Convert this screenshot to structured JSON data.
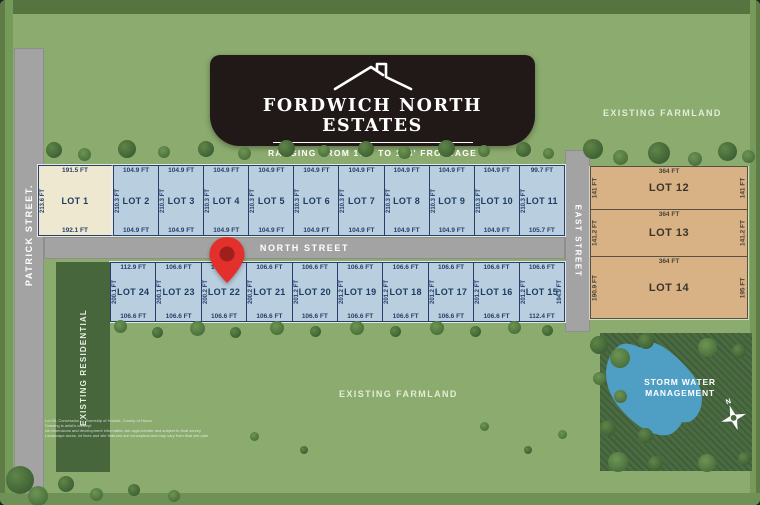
{
  "banner": {
    "title": "FORDWICH NORTH ESTATES",
    "subtitle": "RANGING FROM 104' TO 194' FRONTAGE"
  },
  "streets": {
    "patrick": "PATRICK STREET.",
    "north": "NORTH STREET",
    "east": "EAST STREET"
  },
  "labels": {
    "farmland_top": "EXISTING FARMLAND",
    "farmland_bottom": "EXISTING FARMLAND",
    "residential": "EXISTING RESIDENTIAL",
    "storm_water": "STORM WATER MANAGEMENT",
    "compass_n": "N"
  },
  "colors": {
    "lot_blue": "#b9cedf",
    "lot_cream": "#efe8d0",
    "lot_tan": "#d8b184",
    "road_gray": "#a3a3a3",
    "pin_red": "#e3302c",
    "map_green": "#8cab6e",
    "zone_dark_green": "#47663c",
    "dimension_text": "#27406b"
  },
  "lots": {
    "top_row": [
      {
        "name": "LOT 1",
        "top": "191.5 FT",
        "bottom": "192.1 FT",
        "side": "213.6 FT"
      },
      {
        "name": "LOT 2",
        "top": "104.9 FT",
        "bottom": "104.9 FT",
        "side": "210.3 FT"
      },
      {
        "name": "LOT 3",
        "top": "104.9 FT",
        "bottom": "104.9 FT",
        "side": "210.3 FT"
      },
      {
        "name": "LOT 4",
        "top": "104.9 FT",
        "bottom": "104.9 FT",
        "side": "210.3 FT"
      },
      {
        "name": "LOT 5",
        "top": "104.9 FT",
        "bottom": "104.9 FT",
        "side": "210.3 FT"
      },
      {
        "name": "LOT 6",
        "top": "104.9 FT",
        "bottom": "104.9 FT",
        "side": "210.3 FT"
      },
      {
        "name": "LOT 7",
        "top": "104.9 FT",
        "bottom": "104.9 FT",
        "side": "210.3 FT"
      },
      {
        "name": "LOT 8",
        "top": "104.9 FT",
        "bottom": "104.9 FT",
        "side": "210.3 FT"
      },
      {
        "name": "LOT 9",
        "top": "104.9 FT",
        "bottom": "104.9 FT",
        "side": "210.3 FT"
      },
      {
        "name": "LOT 10",
        "top": "104.9 FT",
        "bottom": "104.9 FT",
        "side": "210.3 FT"
      },
      {
        "name": "LOT 11",
        "top": "99.7 FT",
        "bottom": "105.7 FT",
        "side": "210.3 FT"
      }
    ],
    "bottom_row": [
      {
        "name": "LOT 24",
        "top": "112.9 FT",
        "bottom": "106.6 FT",
        "side": "200.1 FT"
      },
      {
        "name": "LOT 23",
        "top": "106.6 FT",
        "bottom": "106.6 FT",
        "side": "200.1 FT"
      },
      {
        "name": "LOT 22",
        "top": "106.6 FT",
        "bottom": "106.6 FT",
        "side": "200.2 FT"
      },
      {
        "name": "LOT 21",
        "top": "106.6 FT",
        "bottom": "106.6 FT",
        "side": "200.2 FT"
      },
      {
        "name": "LOT 20",
        "top": "106.6 FT",
        "bottom": "106.6 FT",
        "side": "201.2 FT"
      },
      {
        "name": "LOT 19",
        "top": "106.6 FT",
        "bottom": "106.6 FT",
        "side": "201.2 FT"
      },
      {
        "name": "LOT 18",
        "top": "106.6 FT",
        "bottom": "106.6 FT",
        "side": "201.2 FT"
      },
      {
        "name": "LOT 17",
        "top": "106.6 FT",
        "bottom": "106.6 FT",
        "side": "201.2 FT"
      },
      {
        "name": "LOT 16",
        "top": "106.6 FT",
        "bottom": "106.6 FT",
        "side": "201.2 FT"
      },
      {
        "name": "LOT 15",
        "top": "106.6 FT",
        "bottom": "112.4 FT",
        "side": "201.2 FT",
        "right": "194.9 FT"
      }
    ],
    "east_row": [
      {
        "name": "LOT 12",
        "top": "364 FT",
        "left": "141 FT",
        "right": "141 FT"
      },
      {
        "name": "LOT 13",
        "top": "364 FT",
        "left": "141.2 FT",
        "right": "141.2 FT"
      },
      {
        "name": "LOT 14",
        "top": "364 FT",
        "left": "190.9 FT",
        "right": "195 FT"
      }
    ]
  },
  "disclaimer": [
    "Lot 26, Concession C, Township of Howick, County of Huron",
    "Drawing is artist's concept",
    "All dimensions and development information are approximate and subject to final survey",
    "Landscape areas, lot lines and site features are conceptual and may vary from final site plan"
  ]
}
